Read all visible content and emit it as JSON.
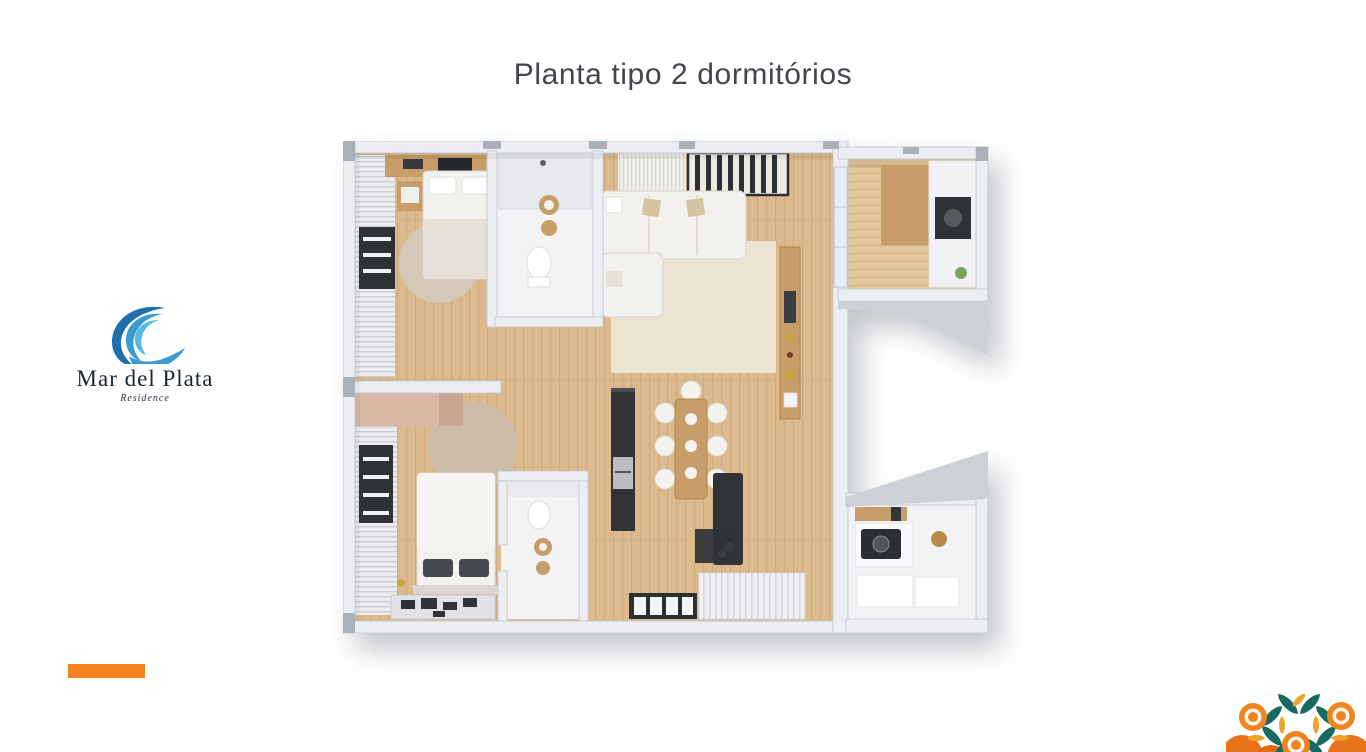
{
  "slide": {
    "title": "Planta tipo 2 dormitórios"
  },
  "logo": {
    "name": "Mar del Plata",
    "subtitle": "Residence"
  },
  "floor_plan": {
    "kind": "3d-top-down-apartment-render",
    "rooms": [
      "bedroom-1",
      "bathroom-1",
      "living-room",
      "terrace-grill-corner",
      "hallway",
      "bedroom-2",
      "bathroom-2",
      "kitchen",
      "dining-area",
      "kitchen-island",
      "entry-deck",
      "laundry-room"
    ]
  },
  "theme": {
    "title-ink": "#41464c",
    "logo-ink": "#1b2534",
    "accent": "#f5821e",
    "wave-dark": "#1d6fae",
    "wave-mid": "#3b9ad0",
    "wave-light": "#56b9e2",
    "wall": "#eceef1",
    "wall-edge": "#c6cad2",
    "wall-dark": "#ccd0d7",
    "wall-deep": "#aab0ba",
    "wood": "#dcba8e",
    "wood-line": "#ccab7e",
    "deck": "#e3c79c",
    "deck-line": "#d2b386",
    "white-floor": "#f3f3f5",
    "soft": "#f3f1ed",
    "soft-edge": "#d9d5cf",
    "dark": "#303439",
    "rug": "#ece4d2",
    "wood-furn": "#c79d6a",
    "wardrobe": "#d9b8a7",
    "teal": "#176a60",
    "amber": "#eda42c",
    "orange": "#ef8420"
  }
}
